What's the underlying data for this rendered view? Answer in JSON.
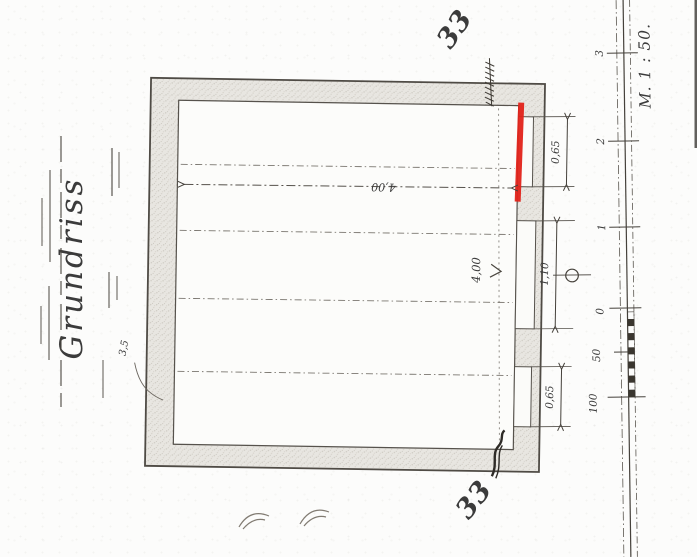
{
  "drawing": {
    "title": "Grundriss",
    "scale": {
      "label": "M. 1 : 50.",
      "tick_labels": [
        "3",
        "2",
        "1",
        "0",
        "50",
        "100"
      ]
    },
    "dimensions": {
      "room_width": "4,00",
      "room_height": "4,00",
      "niche_top": "0,65",
      "niche_middle": "1,10",
      "niche_bottom": "0,65",
      "wall_note": "3,5"
    },
    "annotations": {
      "mark_top_right": "33",
      "mark_bottom_right": "33"
    },
    "colors": {
      "highlight": "#e2231a",
      "ink": "#3b3b3b",
      "wall_fill": "#e8e6e1",
      "paper": "#fcfcfb"
    }
  }
}
